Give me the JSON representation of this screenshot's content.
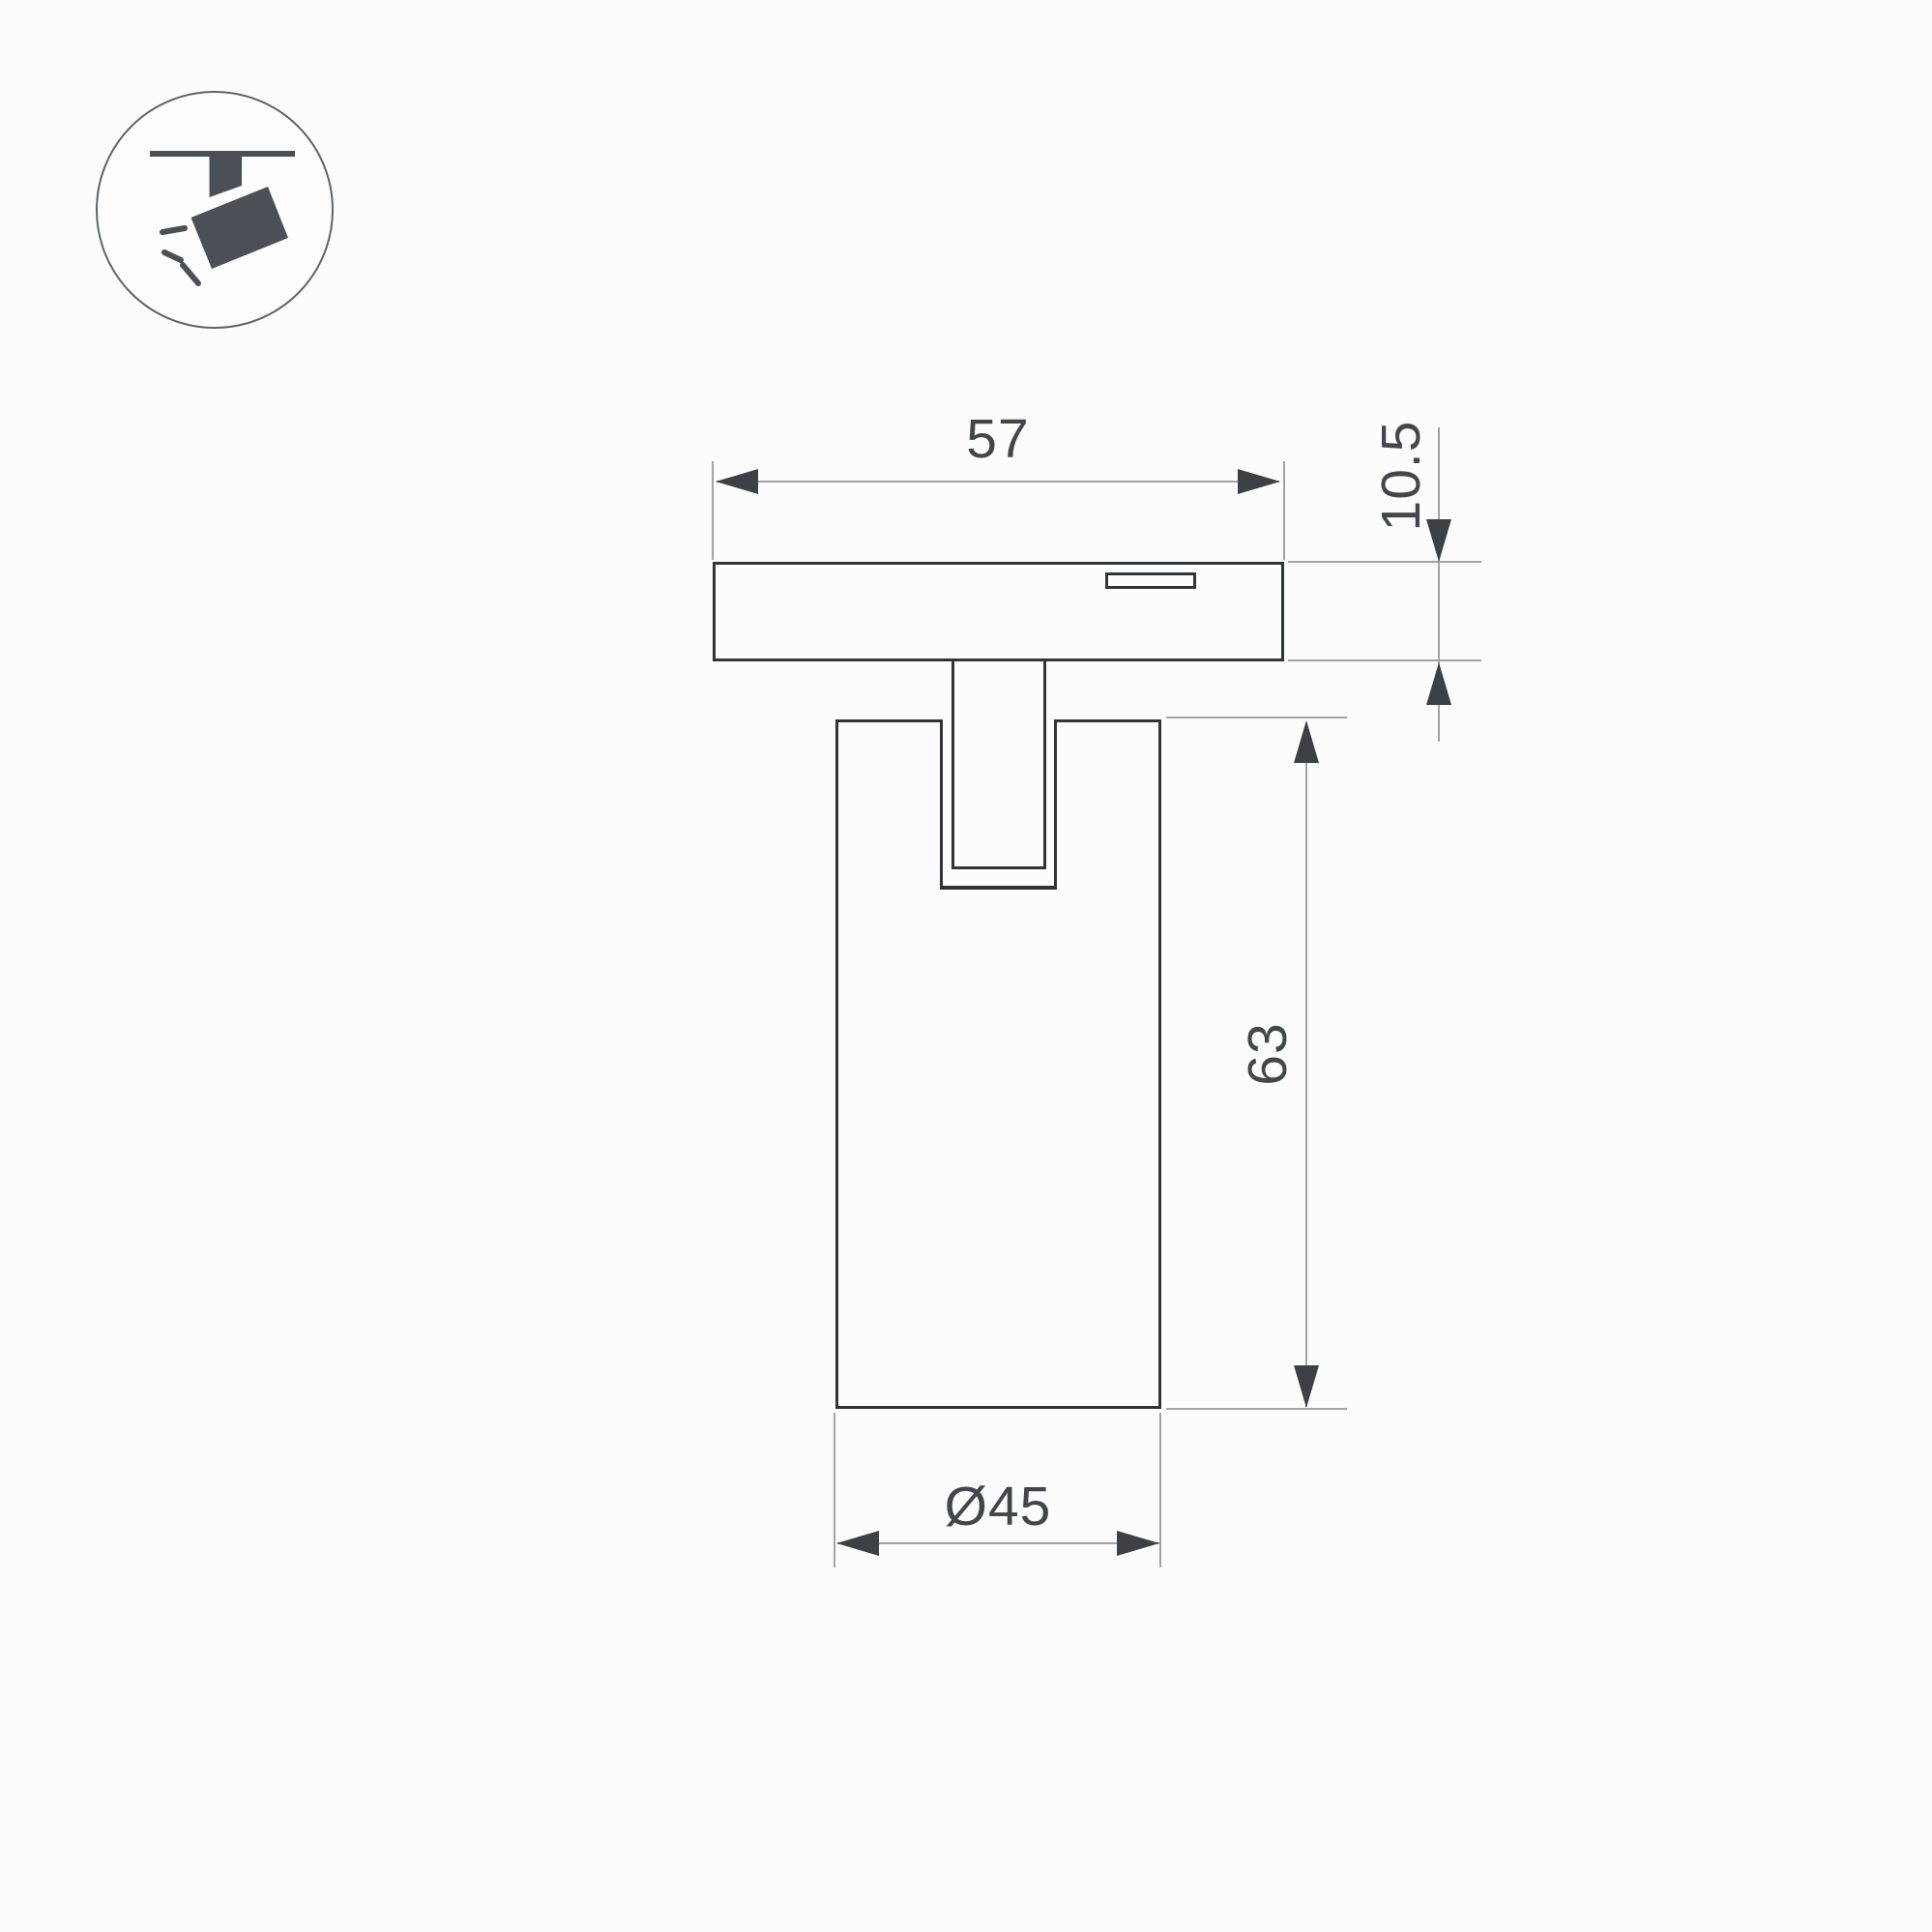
{
  "page": {
    "type": "technical-dimension-drawing",
    "background_color": "#fcfcfc"
  },
  "icon": {
    "symbol": "track-mounted-spotlight",
    "pictogram_color": "#4a5056",
    "circle_border_color": "#5f6468"
  },
  "drawing": {
    "outline_color": "#303539",
    "dimension_line_color": "#a3a3a3",
    "arrow_color": "#3d4145",
    "text_color": "#43474b",
    "labels": {
      "track_adapter_width": "57",
      "track_adapter_height": "10.5",
      "body_height": "63",
      "body_diameter": "Ø45"
    }
  }
}
